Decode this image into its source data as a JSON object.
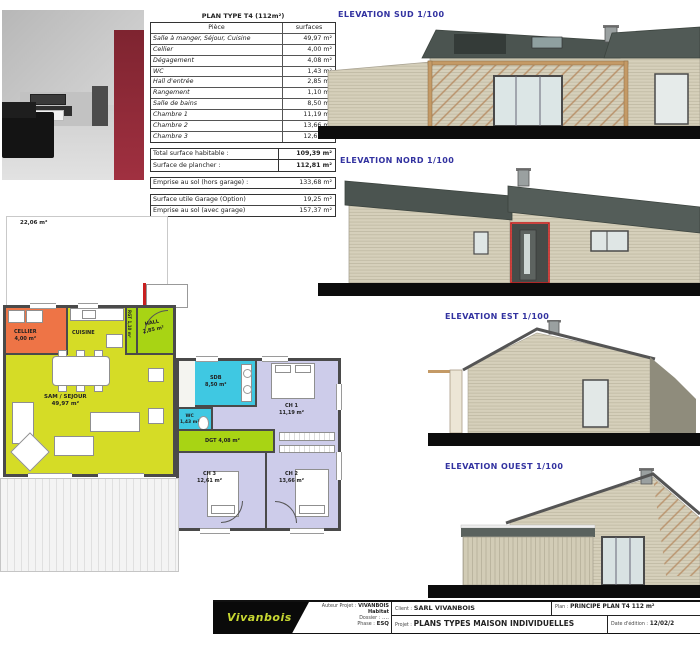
{
  "colors": {
    "plan_yellow": "#d5dc26",
    "plan_green": "#a8d414",
    "plan_orange": "#ee7446",
    "plan_cyan": "#3fc8e2",
    "plan_lavender": "#cdccea",
    "wall_gray": "#4a4a4a",
    "roof_dark": "#4b5450",
    "siding_beige": "#d6d0bb",
    "accent_red": "#c82020",
    "title_blue": "#3232a0"
  },
  "surface_table": {
    "title": "PLAN TYPE T4 (112m²)",
    "headers": {
      "piece": "Pièce",
      "surface": "surfaces"
    },
    "rows": [
      {
        "piece": "Salle à manger, Séjour, Cuisine",
        "surface": "49,97 m²"
      },
      {
        "piece": "Cellier",
        "surface": "4,00 m²"
      },
      {
        "piece": "Dégagement",
        "surface": "4,08 m²"
      },
      {
        "piece": "WC",
        "surface": "1,43 m²"
      },
      {
        "piece": "Hall d'entrée",
        "surface": "2,85 m²"
      },
      {
        "piece": "Rangement",
        "surface": "1,10 m²"
      },
      {
        "piece": "Salle de bains",
        "surface": "8,50 m²"
      },
      {
        "piece": "Chambre 1",
        "surface": "11,19 m²"
      },
      {
        "piece": "Chambre 2",
        "surface": "13,66 m²"
      },
      {
        "piece": "Chambre 3",
        "surface": "12,61 m²"
      }
    ],
    "totals": [
      {
        "label": "Total surface habitable :",
        "value": "109,39 m²"
      },
      {
        "label": "Surface de plancher :",
        "value": "112,81 m²"
      }
    ],
    "emprise_hors": {
      "label": "Emprise au sol (hors garage) :",
      "value": "133,68 m²"
    },
    "garage_rows": [
      {
        "label": "Surface utile Garage (Option)",
        "value": "19,25 m²"
      },
      {
        "label": "Emprise au sol (avec garage)",
        "value": "157,37 m²"
      }
    ]
  },
  "plan": {
    "terrace_area": "22,06 m²",
    "rooms": [
      {
        "name": "CELLIER",
        "area": "4,00 m²"
      },
      {
        "name": "CUISINE",
        "area": ""
      },
      {
        "name": "RGT",
        "area": "1,10 m²"
      },
      {
        "name": "HALL",
        "area": "2,85 m²"
      },
      {
        "name": "SAM / SEJOUR",
        "area": "49,97 m²"
      },
      {
        "name": "SDB",
        "area": "8,50 m²"
      },
      {
        "name": "WC",
        "area": "1,43 m²"
      },
      {
        "name": "DGT  4,08 m²",
        "area": ""
      },
      {
        "name": "CH 1",
        "area": "11,19 m²"
      },
      {
        "name": "CH 3",
        "area": "12,61 m²"
      },
      {
        "name": "CH 2",
        "area": "13,66 m²"
      }
    ]
  },
  "elevations": [
    {
      "title": "ELEVATION SUD 1/100"
    },
    {
      "title": "ELEVATION NORD 1/100"
    },
    {
      "title": "ELEVATION EST 1/100"
    },
    {
      "title": "ELEVATION OUEST 1/100"
    }
  ],
  "titleblock": {
    "logo": "Vivanbois",
    "auteur_label": "Auteur Projet :",
    "auteur": "VIVANBOIS Habitat",
    "dossier_label": "Dossier :",
    "dossier": "....",
    "phase_label": "Phase :",
    "phase": "ESQ",
    "client_label": "Client :",
    "client": "SARL VIVANBOIS",
    "projet_label": "Projet :",
    "projet": "PLANS TYPES MAISON INDIVIDUELLES",
    "plan_label": "Plan :",
    "plan": "PRINCIPE PLAN T4 112 m²",
    "date_label": "Date d'édition :",
    "date": "12/02/2"
  }
}
